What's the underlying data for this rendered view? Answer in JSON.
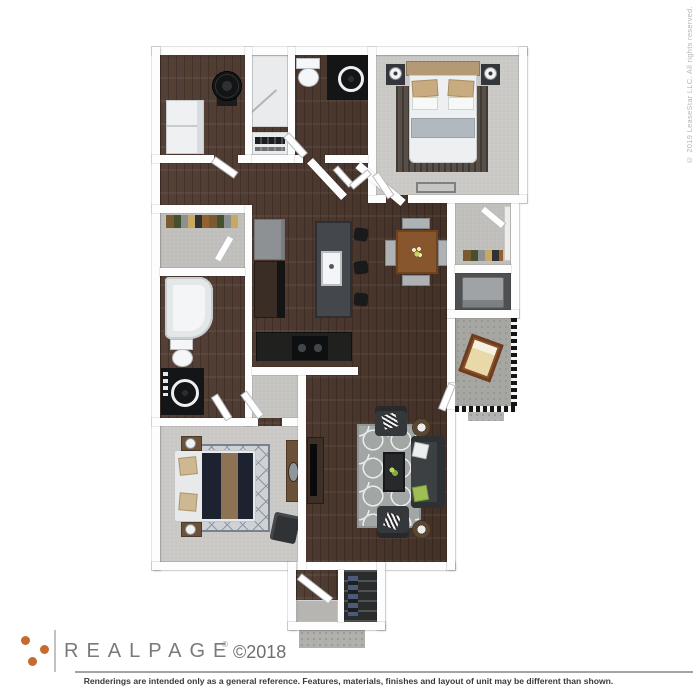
{
  "watermark": {
    "text": "© 2019 LeaseStar LLC. All rights reserved."
  },
  "footer": {
    "brand": {
      "name": "REALPAGE",
      "registered_mark": "®",
      "copyright": "©2018"
    },
    "disclaimer": "Renderings are intended only as a general reference. Features, materials, finishes and layout of unit may be different than shown."
  },
  "palette": {
    "background": "#ffffff",
    "brand_dot_orange": "#c8692e",
    "brand_text_gray": "#7a7a7a",
    "watermark_gray": "#b5b5b5",
    "disclaimer_text": "#3a3a3a",
    "wall_white": "#fdfdfd",
    "wood_floor": "#4b362b",
    "carpet_gray": "#c9c8c5",
    "concrete_gray": "#a6a6a3",
    "island_charcoal": "#44484d",
    "dining_wood": "#87562d",
    "sofa_charcoal": "#3c4043",
    "living_rug_gray": "#a2a7a6",
    "bed_comforter_navy": "#1c2230",
    "accent_tan": "#c8ab80",
    "accent_green": "#9fbf56"
  }
}
